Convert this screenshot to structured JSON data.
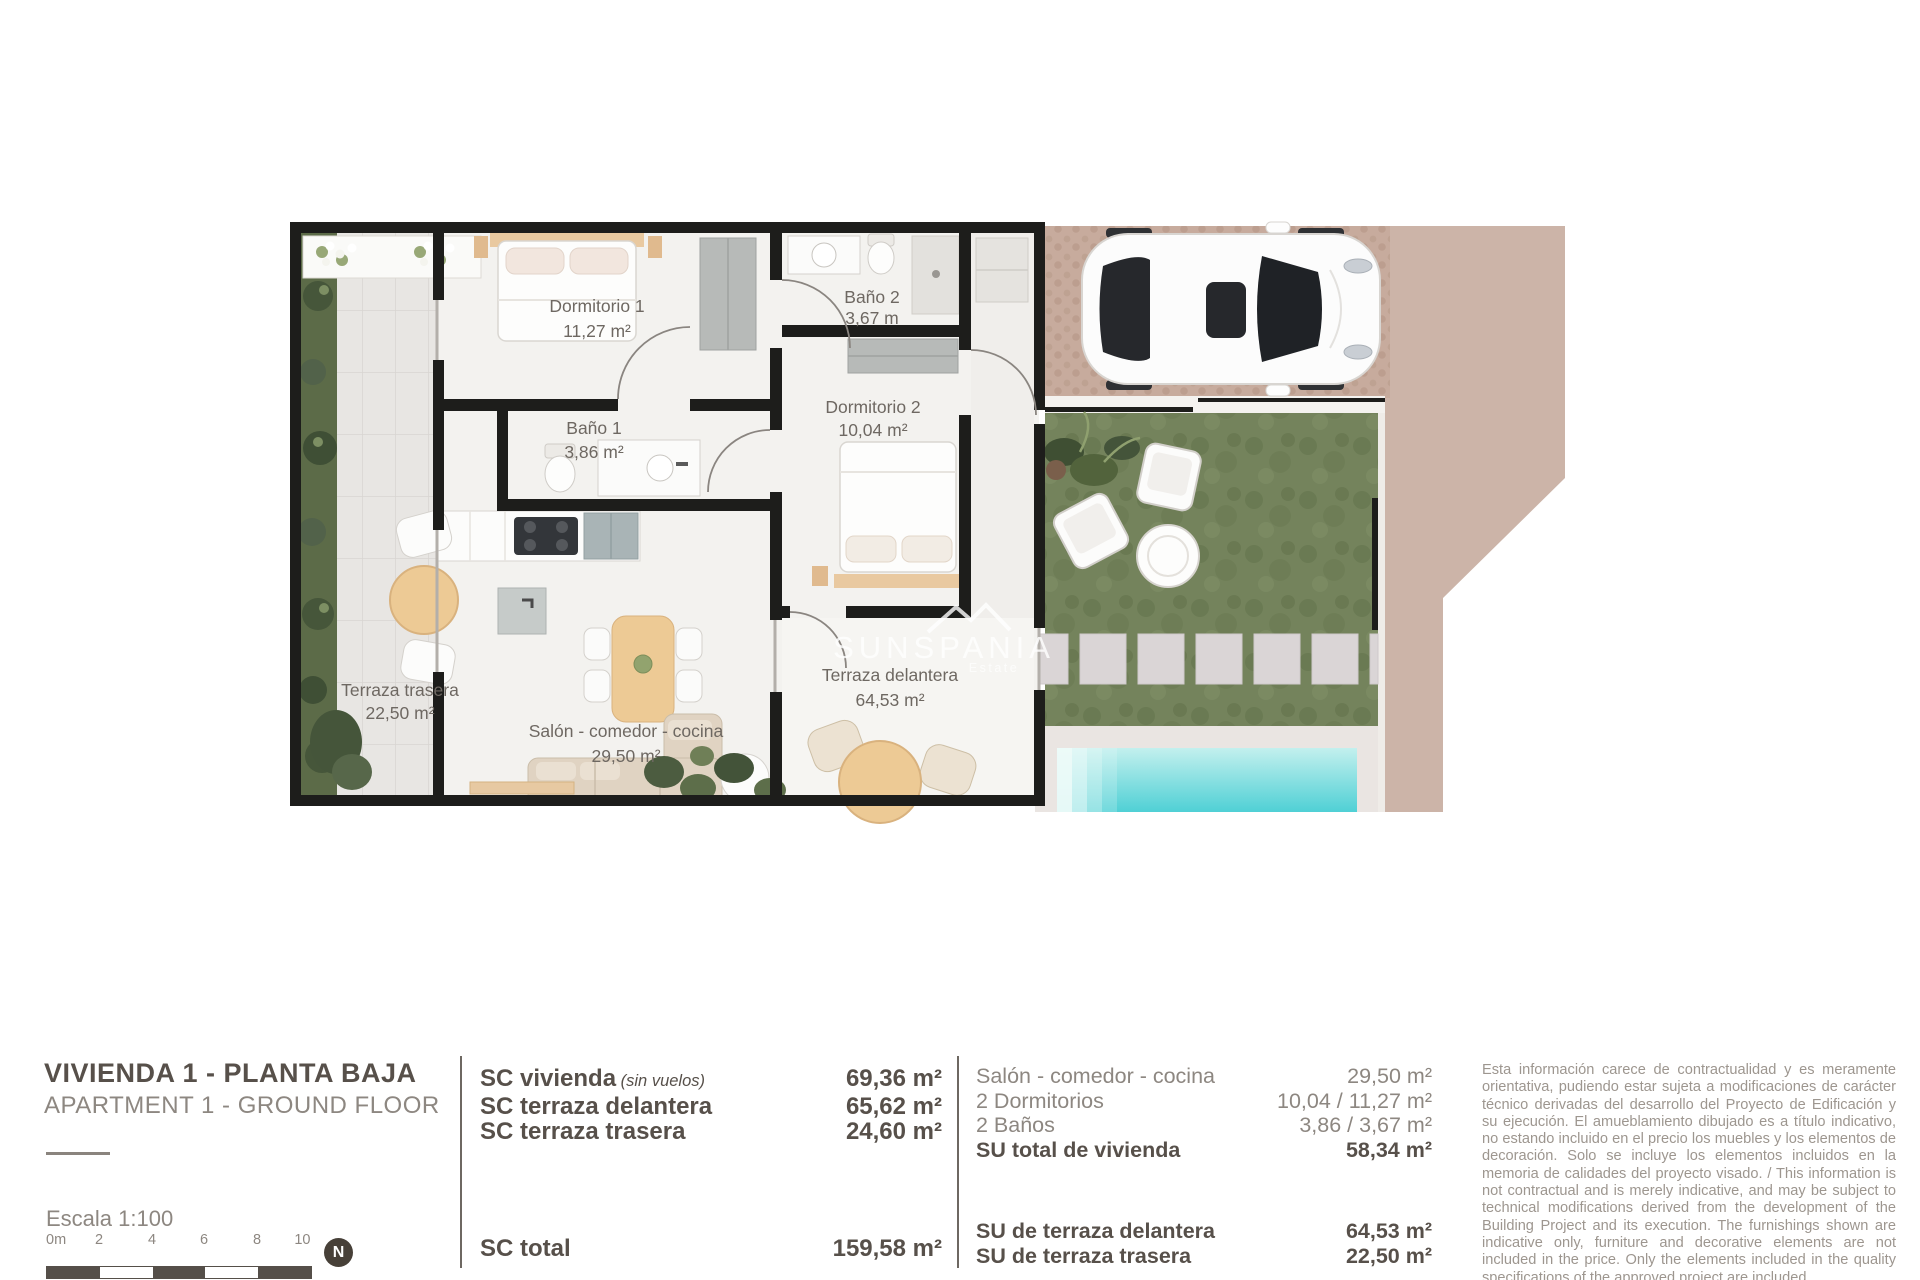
{
  "colors": {
    "wall": "#1d1d1b",
    "grass": "#74835c",
    "paving_smooth": "#ccb4a8",
    "paving_cobble": "#c7ab9d",
    "pool_water": "#4fd0d5",
    "wood": "#edca95",
    "text_dark": "#57504a",
    "text_gray": "#8d8781",
    "text_light": "#9d968f"
  },
  "plan": {
    "watermark": {
      "brand": "SUNSPANIA",
      "sub": "Estate"
    },
    "rooms": {
      "dormitorio1": {
        "name": "Dormitorio 1",
        "area": "11,27 m²"
      },
      "bano1": {
        "name": "Baño 1",
        "area": "3,86 m²"
      },
      "bano2": {
        "name": "Baño 2",
        "area": "3,67 m"
      },
      "dormitorio2": {
        "name": "Dormitorio 2",
        "area": "10,04 m²"
      },
      "terraza_trasera": {
        "name": "Terraza trasera",
        "area": "22,50 m²"
      },
      "salon": {
        "name": "Salón - comedor - cocina",
        "area": "29,50 m²"
      },
      "terraza_delantera": {
        "name": "Terraza delantera",
        "area": "64,53 m²"
      }
    }
  },
  "footer": {
    "title": "VIVIENDA 1 - PLANTA BAJA",
    "subtitle": "APARTMENT 1 - GROUND FLOOR",
    "scale": {
      "label": "Escala  1:100",
      "ticks": [
        "0m",
        "2",
        "4",
        "6",
        "8",
        "10"
      ],
      "north": "N"
    },
    "sc": {
      "rows": [
        {
          "label": "SC vivienda",
          "note": " (sin vuelos)",
          "value": "69,36 m²"
        },
        {
          "label": "SC terraza delantera",
          "note": "",
          "value": "65,62 m²"
        },
        {
          "label": "SC terraza trasera",
          "note": "",
          "value": "24,60 m²"
        }
      ],
      "total_label": "SC total",
      "total_value": "159,58 m²"
    },
    "su": {
      "rows": [
        {
          "label": "Salón - comedor - cocina",
          "value": "29,50 m²"
        },
        {
          "label": "2 Dormitorios",
          "value": "10,04 / 11,27 m²"
        },
        {
          "label": "2 Baños",
          "value": "3,86 / 3,67 m²"
        },
        {
          "label": "SU total de vivienda",
          "value": "58,34 m²"
        }
      ],
      "rows2": [
        {
          "label": "SU de terraza delantera",
          "value": "64,53 m²"
        },
        {
          "label": "SU de terraza trasera",
          "value": "22,50 m²"
        }
      ]
    },
    "disclaimer": "Esta información carece de contractualidad y es meramente orientativa, pudiendo estar sujeta a modificaciones de carácter técnico derivadas del desarrollo del Proyecto de Edificación y su ejecución. El amueblamiento dibujado es a título indicativo, no estando incluido en el precio los muebles y los elementos de decoración. Solo se incluye los elementos incluidos en la memoria de calidades del proyecto visado. / This information is not contractual and is merely indicative, and may be subject to technical modifications derived from the development of the Building Project and its execution. The furnishings shown are indicative only, furniture and decorative elements are not included in the price. Only the elements included in the quality specifications of the approved project are included."
  }
}
